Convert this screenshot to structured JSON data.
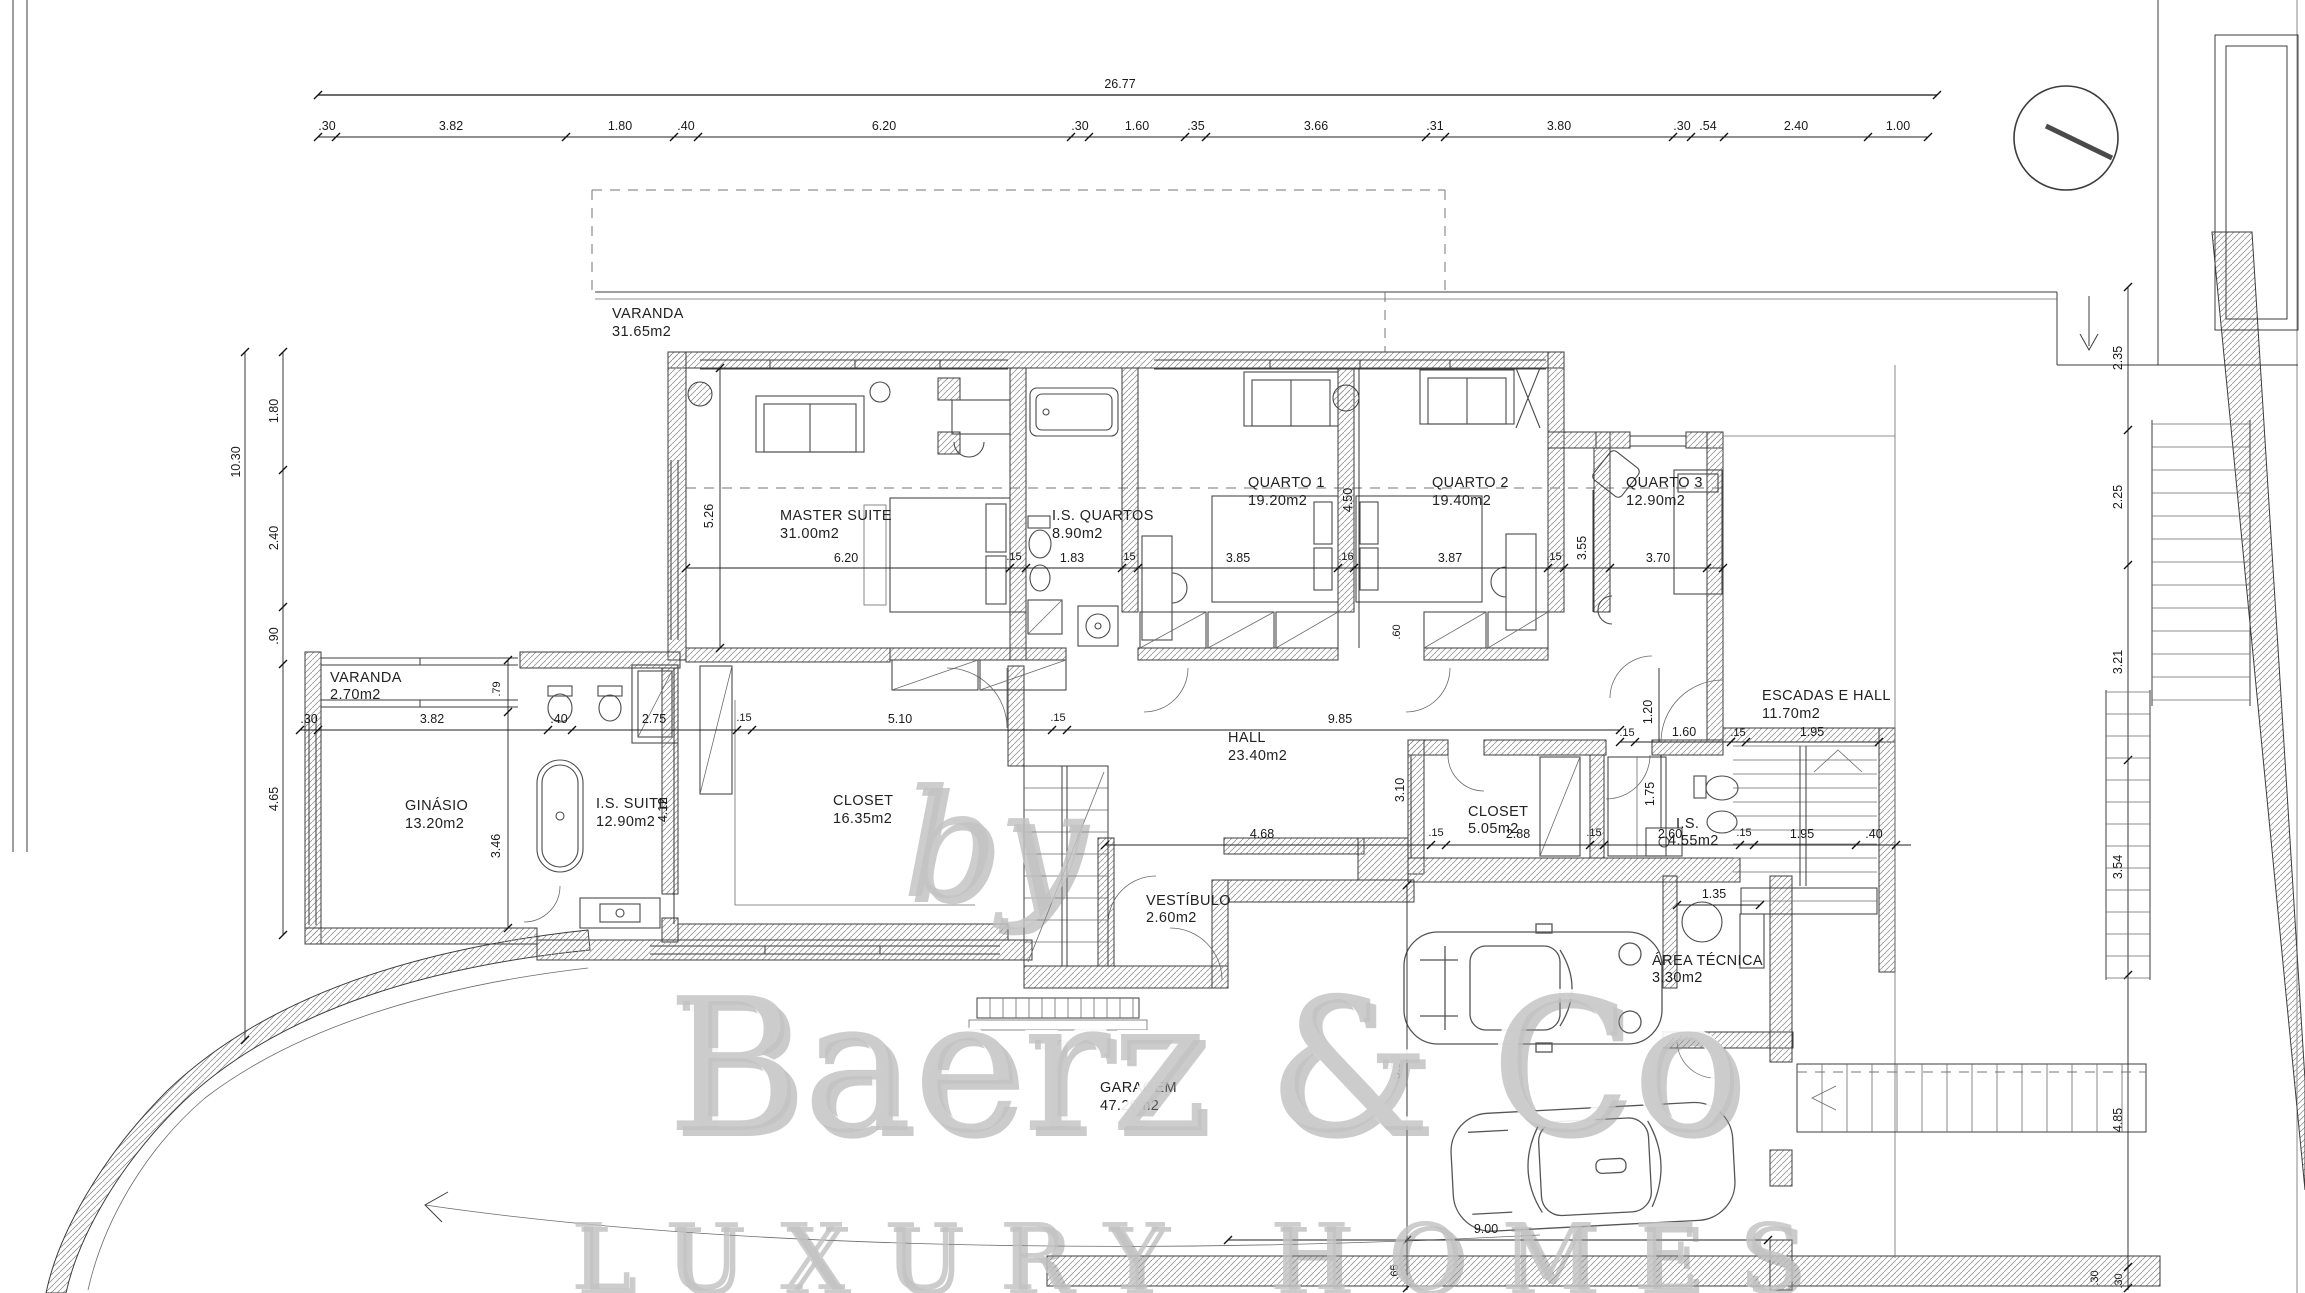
{
  "watermark": {
    "prefix": "by",
    "brand": "Baerz & Co",
    "tagline": "LUXURY HOMES"
  },
  "rooms": [
    {
      "name": "VARANDA",
      "area": "31.65m2"
    },
    {
      "name": "MASTER SUITE",
      "area": "31.00m2"
    },
    {
      "name": "I.S. QUARTOS",
      "area": "8.90m2"
    },
    {
      "name": "QUARTO 1",
      "area": "19.20m2"
    },
    {
      "name": "QUARTO 2",
      "area": "19.40m2"
    },
    {
      "name": "QUARTO 3",
      "area": "12.90m2"
    },
    {
      "name": "VARANDA",
      "area": "2.70m2"
    },
    {
      "name": "GINÁSIO",
      "area": "13.20m2"
    },
    {
      "name": "I.S. SUITE",
      "area": "12.90m2"
    },
    {
      "name": "CLOSET",
      "area": "16.35m2"
    },
    {
      "name": "HALL",
      "area": "23.40m2"
    },
    {
      "name": "VESTÍBULO",
      "area": "2.60m2"
    },
    {
      "name": "CLOSET",
      "area": "5.05m2"
    },
    {
      "name": "I.S.",
      "area": "4.55m2"
    },
    {
      "name": "ESCADAS E HALL",
      "area": "11.70m2"
    },
    {
      "name": "ÁREA TÉCNICA",
      "area": "3.30m2"
    },
    {
      "name": "GARAGEM",
      "area": "47.20m2"
    }
  ],
  "dims": {
    "top_total": "26.77",
    "top_segments": [
      ".30",
      "3.82",
      "1.80",
      ".40",
      "6.20",
      ".30",
      "1.60",
      ".35",
      "3.66",
      ".31",
      "3.80",
      ".30",
      ".54",
      "2.40",
      "1.00"
    ],
    "left_total": "10.30",
    "left_segments": [
      "1.80",
      "2.40",
      ".90",
      "4.65"
    ],
    "right_segments": [
      "2.35",
      "2.25",
      "3.21",
      "3.54",
      "4.85",
      ".30"
    ],
    "bedroom_chain": [
      "6.20",
      "1.83",
      "3.85",
      "3.87",
      "3.70"
    ],
    "mid_chain": [
      ".30",
      "3.82",
      ".40",
      "2.75",
      "5.10",
      "9.85"
    ],
    "stair_chain": [
      "1.60",
      "1.95"
    ],
    "south_chain": [
      "4.68",
      "2.88",
      "2.60",
      "1.95",
      ".40"
    ],
    "wall_15": ".15",
    "wall_16": ".16",
    "verticals": {
      "master": "5.26",
      "quarto1": "4.50",
      "quarto3": "3.55",
      "wardrobe": ".60",
      "varanda": ".79",
      "ginasio": "3.46",
      "is_suite": "4.12",
      "closet_row": "3.10",
      "stair": "1.20",
      "is_wc": "1.75",
      "garage": "5.90",
      "kerb": ".65",
      "bottom_right": ".30"
    },
    "garage_width": "9.00",
    "area_tecnica": "1.35"
  }
}
